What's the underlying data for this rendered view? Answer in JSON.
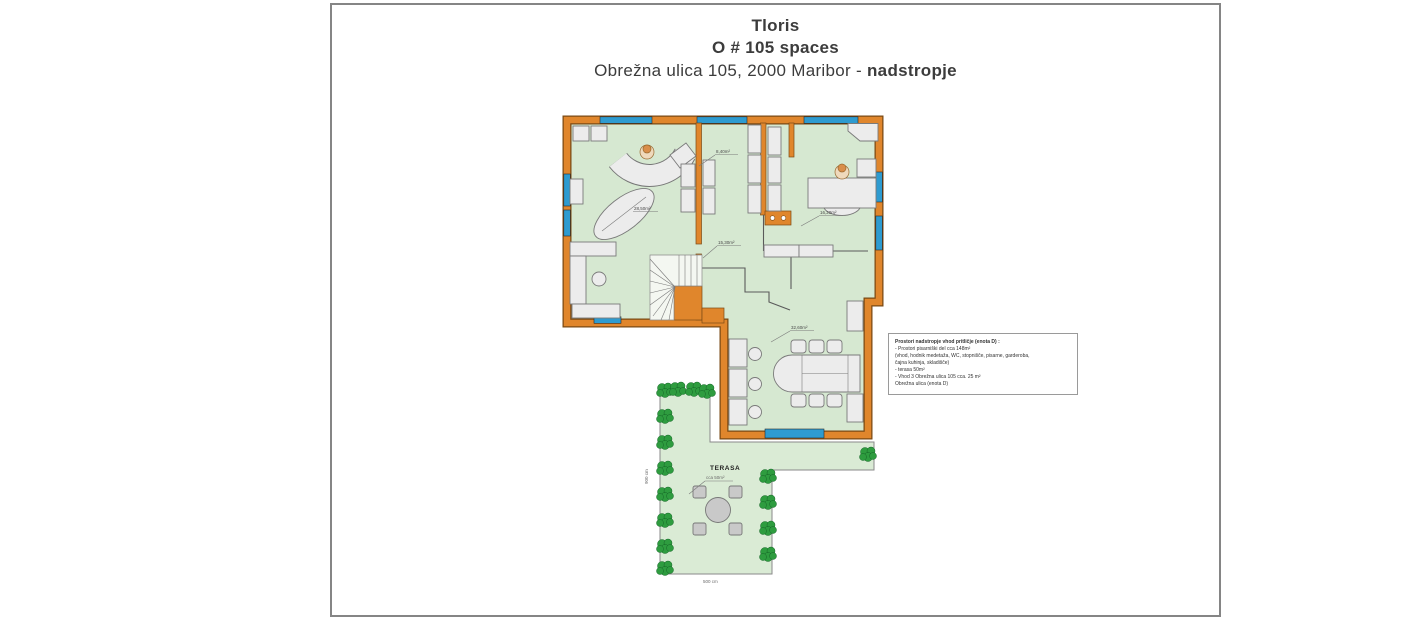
{
  "header": {
    "line1": "Tloris",
    "line2": "O # 105 spaces",
    "line3_regular": "Obrežna ulica 105, 2000 Maribor - ",
    "line3_bold": "nadstropje"
  },
  "info_box": {
    "lines": [
      {
        "text": "Prostori nadstropje vhod pritličje (enota D) :",
        "bold": true
      },
      {
        "text": "- Prostori pisarniški del cca 148m²",
        "bold": false
      },
      {
        "text": "(vhod, hodnik medetaža, WC, stopnišče, pisarne, garderoba,",
        "bold": false
      },
      {
        "text": "čajna kuhinja, skladišče)",
        "bold": false
      },
      {
        "text": "- terasa 50m²",
        "bold": false
      },
      {
        "text": "- Vhod 3  Obrežna ulica 105 cca. 25 m²",
        "bold": false
      },
      {
        "text": "Obrežna ulica (enota  D)",
        "bold": false
      }
    ]
  },
  "plan": {
    "room_labels": {
      "left_office": "28,50m²",
      "middle_room": "8,40m²",
      "right_office": "16,20m²",
      "corridor": "15,30m²",
      "conference": "32,60m²"
    },
    "terrace": {
      "name": "TERASA",
      "area": "cca 50m²",
      "bottom_dim": "500 cm",
      "left_dim": "900 cm"
    },
    "colors": {
      "wall": "#E0862C",
      "floor": "#D6E8D1",
      "terrace": "#DAEBD5",
      "window": "#2E9BD0",
      "furniture": "#ECECEC",
      "plant": "#2E9C3F",
      "person": "#D98E4A"
    }
  }
}
